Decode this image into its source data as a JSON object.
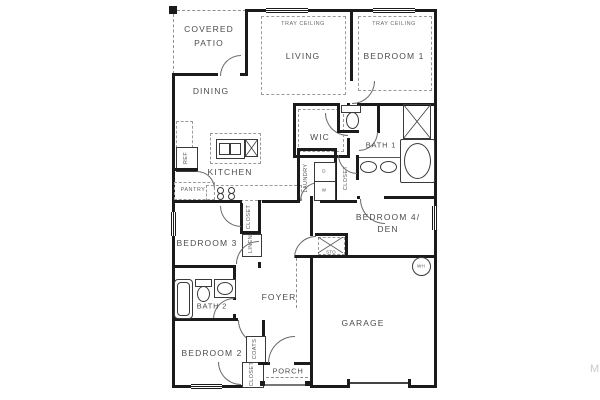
{
  "labels": {
    "covered_patio_1": "COVERED",
    "covered_patio_2": "PATIO",
    "tray_ceiling": "TRAY CEILING",
    "living": "LIVING",
    "bedroom1": "BEDROOM 1",
    "dining": "DINING",
    "wic": "WIC",
    "bath1": "BATH 1",
    "kitchen": "KITCHEN",
    "pantry": "PANTRY",
    "ref": "REF",
    "laundry": "LAUNDRY",
    "dryer": "D",
    "washer": "W",
    "closet": "CLOSET",
    "linen": "LINEN",
    "bedroom4_1": "BEDROOM 4/",
    "bedroom4_2": "DEN",
    "bedroom3": "BEDROOM 3",
    "storage": "STO",
    "water_heater": "WH",
    "foyer": "FOYER",
    "bath2": "BATH 2",
    "bedroom2": "BEDROOM 2",
    "coats": "COATS",
    "porch": "PORCH",
    "garage": "GARAGE",
    "watermark": "M"
  },
  "colors": {
    "wall": "#1b1b1b",
    "label": "#4d4d4d",
    "dashed": "#9a9a9a",
    "watermark": "#c9c9c9"
  }
}
